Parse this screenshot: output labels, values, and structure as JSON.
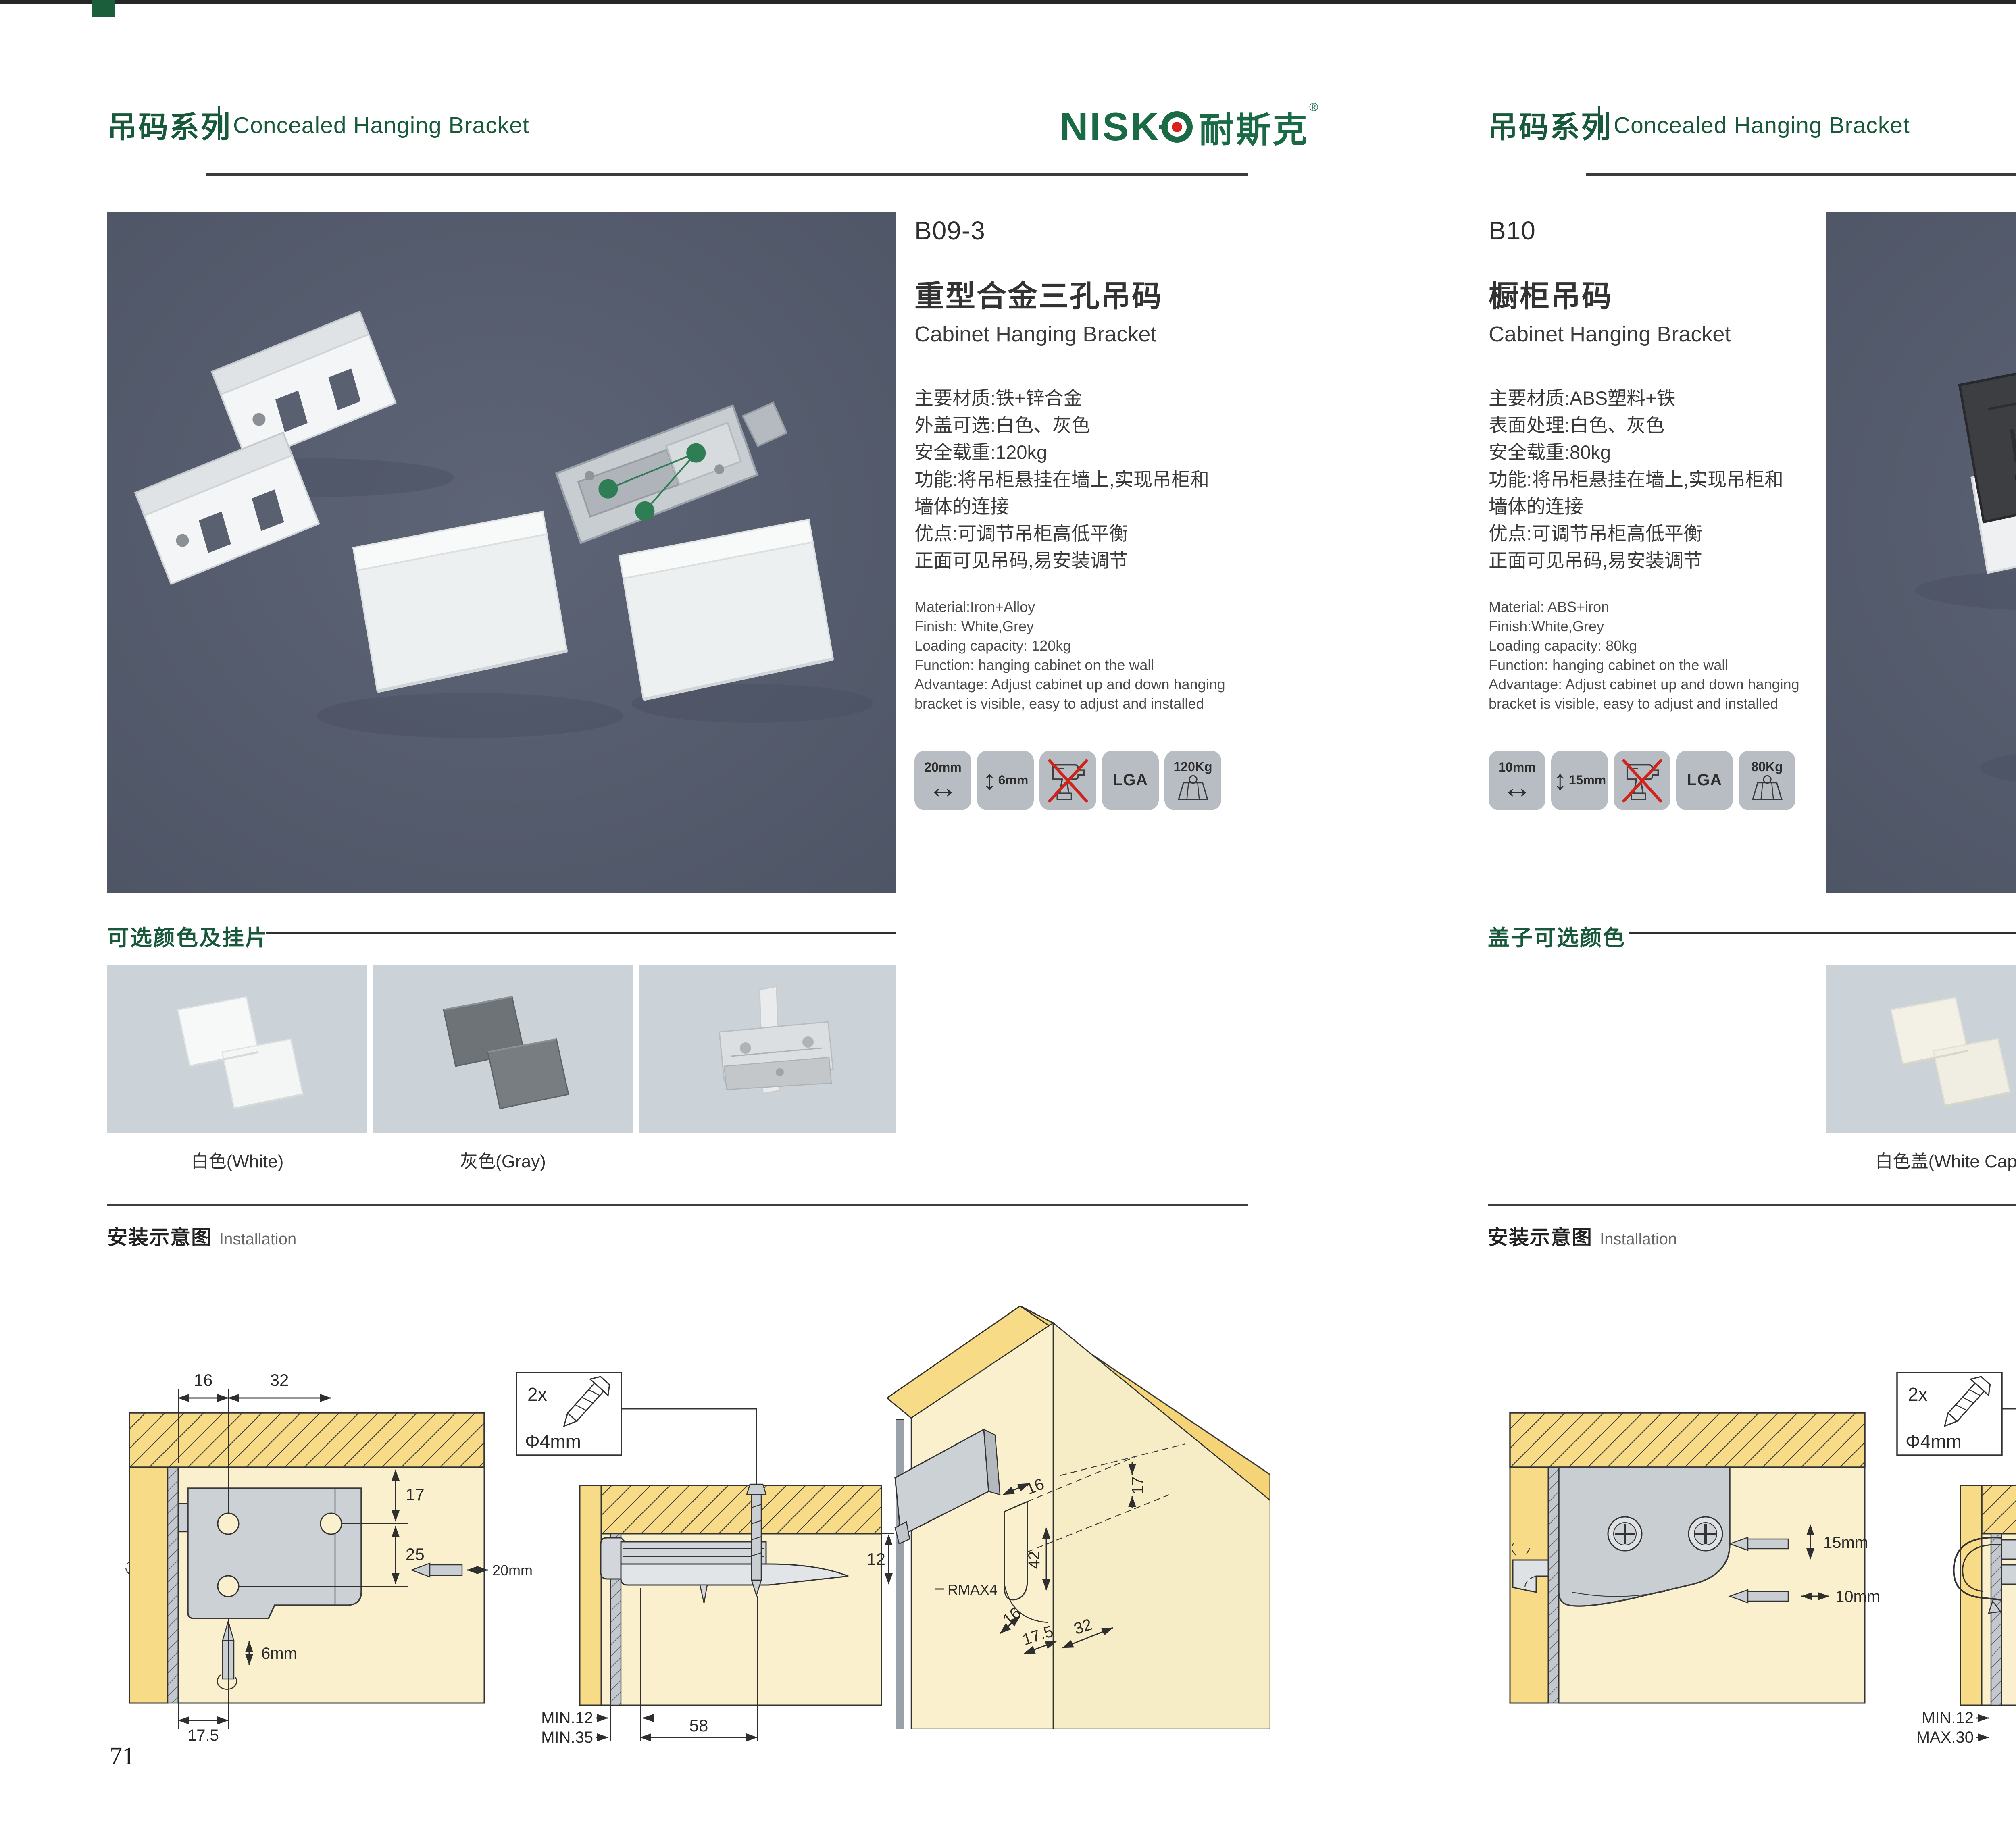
{
  "brand": {
    "latin": "NISK",
    "cn": "耐斯克",
    "registered": "®"
  },
  "left_page": {
    "page_number": "71",
    "header": {
      "series_cn": "吊码系列",
      "series_en": "Concealed Hanging Bracket"
    },
    "product": {
      "code": "B09-3",
      "name_cn": "重型合金三孔吊码",
      "name_en": "Cabinet Hanging Bracket",
      "specs_cn": [
        "主要材质:铁+锌合金",
        "外盖可选:白色、灰色",
        "安全载重:120kg",
        "功能:将吊柜悬挂在墙上,实现吊柜和",
        "墙体的连接",
        "优点:可调节吊柜高低平衡",
        "正面可见吊码,易安装调节"
      ],
      "specs_en": [
        "Material:Iron+Alloy",
        "Finish: White,Grey",
        "Loading capacity: 120kg",
        "Function: hanging cabinet on the wall",
        "Advantage: Adjust cabinet up and down hanging",
        "bracket is visible, easy to adjust and installed"
      ],
      "badge_w": "20mm",
      "badge_h": "6mm",
      "badge_cert": "LGA",
      "badge_load": "120Kg"
    },
    "colors": {
      "title": "可选颜色及挂片",
      "labels": [
        "白色(White)",
        "灰色(Gray)"
      ]
    },
    "install": {
      "title_cn": "安装示意图",
      "title_en": "Installation",
      "d1": {
        "top1": "16",
        "top2": "32",
        "r1": "17",
        "r2": "25",
        "screw_h": "20mm",
        "screw_v": "6mm",
        "bottom": "17.5"
      },
      "d2": {
        "qty": "2x",
        "dia": "Φ4mm",
        "right": "12",
        "b1": "MIN.12",
        "b2": "MIN.35",
        "b3": "58"
      },
      "d3": {
        "a": "17",
        "b": "16",
        "c": "42",
        "r": "RMAX4",
        "d": "16",
        "e": "17.5",
        "f": "32"
      }
    }
  },
  "right_page": {
    "page_number": "72",
    "header": {
      "series_cn": "吊码系列",
      "series_en": "Concealed Hanging Bracket"
    },
    "product": {
      "code": "B10",
      "name_cn": "橱柜吊码",
      "name_en": "Cabinet Hanging Bracket",
      "specs_cn": [
        "主要材质:ABS塑料+铁",
        "表面处理:白色、灰色",
        "安全载重:80kg",
        "功能:将吊柜悬挂在墙上,实现吊柜和",
        "墙体的连接",
        "优点:可调节吊柜高低平衡",
        "正面可见吊码,易安装调节"
      ],
      "specs_en": [
        "Material: ABS+iron",
        "Finish:White,Grey",
        "Loading capacity: 80kg",
        "Function: hanging cabinet on the wall",
        "Advantage: Adjust cabinet up and down hanging",
        "bracket is visible, easy to adjust and installed"
      ],
      "badge_w": "10mm",
      "badge_h": "15mm",
      "badge_cert": "LGA",
      "badge_load": "80Kg"
    },
    "colors": {
      "title": "盖子可选颜色",
      "labels": [
        "白色盖(White Cap)",
        "灰色盖(Gray Cap)"
      ]
    },
    "install": {
      "title_cn": "安装示意图",
      "title_en": "Installation",
      "d1": {
        "v": "15mm",
        "h": "10mm"
      },
      "d2": {
        "qty": "2x",
        "dia": "Φ4mm",
        "right": "18",
        "b1": "MIN.12",
        "b2": "MAX.30",
        "b3": "67"
      },
      "d3": {
        "a": "13",
        "c": "42",
        "r": "RMAX4",
        "d": "19",
        "e": "17",
        "f": "32"
      }
    }
  }
}
